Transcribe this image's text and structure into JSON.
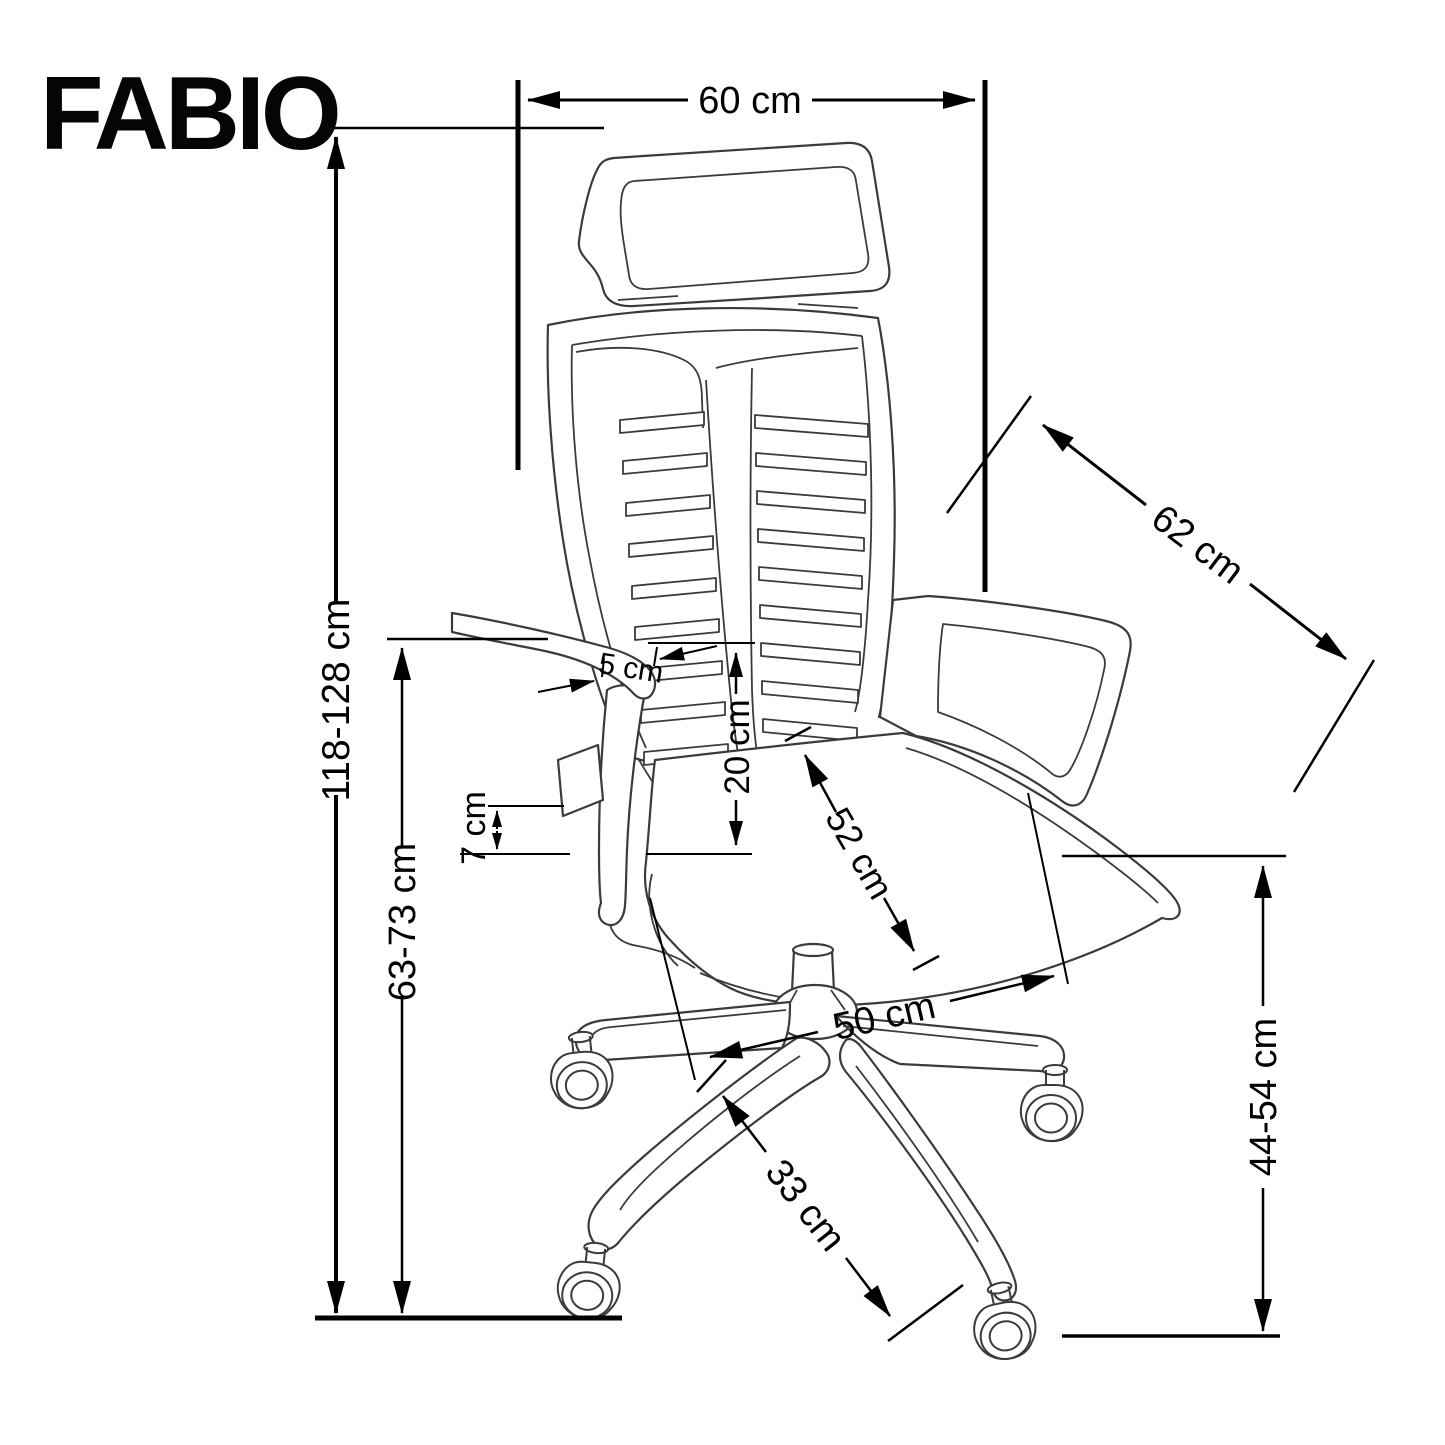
{
  "title": "FABIO",
  "unit": "cm",
  "colors": {
    "background": "#ffffff",
    "ink": "#000000",
    "chair_line": "#3b3b3b"
  },
  "dims": {
    "top_width": "60 cm",
    "backrest_width": "62 cm",
    "total_height": "118-128 cm",
    "backrest_height": "63-73 cm",
    "armrest_inset": "5 cm",
    "backrest_above_seat": "20 cm",
    "armrest_pad": "7 cm",
    "seat_depth": "52 cm",
    "seat_width": "50 cm",
    "base_leg": "33 cm",
    "seat_height": "44-54 cm"
  }
}
